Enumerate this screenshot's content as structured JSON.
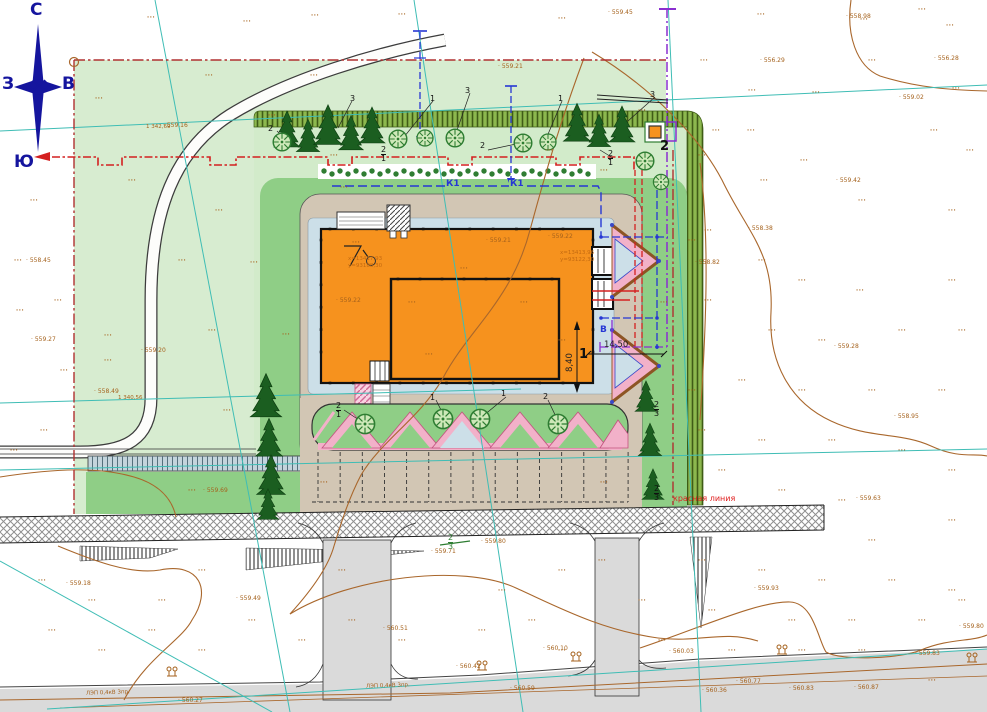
{
  "compass": {
    "n": "С",
    "s": "Ю",
    "w": "З",
    "e": "В"
  },
  "labels": {
    "red_line": "красная линия",
    "sewer": "К1",
    "water": "В",
    "dim_w": "14,50",
    "dim_h": "8,40",
    "bld_no": "1",
    "tf_no": "2",
    "power": "ЛЭП 0,4кВ 3пр.",
    "grid1": "1 342,69",
    "grid2": "1 340,56"
  },
  "coords": {
    "c1x": "х=13417,93",
    "c1y": "у=93188,30",
    "c2x": "х=13413,96",
    "c2y": "у=93122,30"
  },
  "colors": {
    "site_green": "#d7ecd0",
    "lawn_green": "#8fce86",
    "berm_green": "#8cb84e",
    "building_orange": "#f6921e",
    "pad_beige": "#d2c6b4",
    "apron_blue": "#ccdfe8",
    "road_gray": "#dadada",
    "pink": "#f2b1c9",
    "boundary_red": "#c23030",
    "utility_red": "#d42020",
    "utility_blue": "#2637d4",
    "utility_purple": "#8a2fd0",
    "survey_teal": "#3fbdb5",
    "contour_brown": "#a9672c",
    "compass_blue": "#15159e"
  },
  "elevations": [
    [
      163,
      123,
      "559.16"
    ],
    [
      498,
      64,
      "559.21"
    ],
    [
      608,
      10,
      "559.45"
    ],
    [
      846,
      14,
      "558.98"
    ],
    [
      934,
      56,
      "556.28"
    ],
    [
      899,
      95,
      "559.02"
    ],
    [
      760,
      58,
      "556.29"
    ],
    [
      836,
      178,
      "559.42"
    ],
    [
      748,
      226,
      "558.38"
    ],
    [
      695,
      260,
      "558.82"
    ],
    [
      26,
      258,
      "558.45"
    ],
    [
      31,
      337,
      "559.27"
    ],
    [
      141,
      348,
      "559.20"
    ],
    [
      94,
      389,
      "558.49"
    ],
    [
      203,
      488,
      "559.69"
    ],
    [
      336,
      298,
      "559.22"
    ],
    [
      486,
      238,
      "559.21"
    ],
    [
      548,
      234,
      "559.22"
    ],
    [
      834,
      344,
      "559.28"
    ],
    [
      894,
      414,
      "558.95"
    ],
    [
      856,
      496,
      "559.63"
    ],
    [
      66,
      581,
      "559.18"
    ],
    [
      236,
      596,
      "559.49"
    ],
    [
      431,
      549,
      "559.71"
    ],
    [
      481,
      539,
      "559.80"
    ],
    [
      543,
      646,
      "560.10"
    ],
    [
      456,
      664,
      "560.42"
    ],
    [
      669,
      649,
      "560.03"
    ],
    [
      754,
      586,
      "559.93"
    ],
    [
      915,
      651,
      "559.83"
    ],
    [
      959,
      624,
      "559.80"
    ],
    [
      736,
      679,
      "560.77"
    ],
    [
      702,
      688,
      "560.36"
    ],
    [
      789,
      686,
      "560.83"
    ],
    [
      854,
      685,
      "560.87"
    ],
    [
      178,
      698,
      "560.27"
    ],
    [
      383,
      626,
      "560.51"
    ],
    [
      510,
      686,
      "560.59"
    ]
  ],
  "veg_dots": [
    [
      147,
      15
    ],
    [
      243,
      19
    ],
    [
      311,
      13
    ],
    [
      398,
      12
    ],
    [
      558,
      16
    ],
    [
      757,
      12
    ],
    [
      860,
      17
    ],
    [
      918,
      7
    ],
    [
      946,
      23
    ],
    [
      700,
      58
    ],
    [
      812,
      90
    ],
    [
      748,
      88
    ],
    [
      868,
      58
    ],
    [
      952,
      86
    ],
    [
      930,
      128
    ],
    [
      966,
      148
    ],
    [
      747,
      128
    ],
    [
      800,
      158
    ],
    [
      712,
      128
    ],
    [
      760,
      178
    ],
    [
      858,
      198
    ],
    [
      948,
      208
    ],
    [
      704,
      228
    ],
    [
      758,
      258
    ],
    [
      798,
      278
    ],
    [
      856,
      288
    ],
    [
      948,
      278
    ],
    [
      704,
      298
    ],
    [
      768,
      328
    ],
    [
      818,
      338
    ],
    [
      898,
      328
    ],
    [
      958,
      328
    ],
    [
      738,
      378
    ],
    [
      798,
      388
    ],
    [
      868,
      388
    ],
    [
      938,
      388
    ],
    [
      698,
      428
    ],
    [
      758,
      438
    ],
    [
      828,
      438
    ],
    [
      898,
      448
    ],
    [
      948,
      468
    ],
    [
      718,
      468
    ],
    [
      778,
      488
    ],
    [
      838,
      498
    ],
    [
      948,
      518
    ],
    [
      868,
      538
    ],
    [
      698,
      558
    ],
    [
      758,
      568
    ],
    [
      818,
      578
    ],
    [
      888,
      578
    ],
    [
      948,
      588
    ],
    [
      708,
      608
    ],
    [
      788,
      618
    ],
    [
      848,
      618
    ],
    [
      918,
      618
    ],
    [
      958,
      598
    ],
    [
      728,
      648
    ],
    [
      798,
      648
    ],
    [
      858,
      648
    ],
    [
      928,
      678
    ],
    [
      638,
      598
    ],
    [
      658,
      638
    ],
    [
      598,
      558
    ],
    [
      558,
      568
    ],
    [
      498,
      588
    ],
    [
      528,
      618
    ],
    [
      558,
      648
    ],
    [
      478,
      628
    ],
    [
      398,
      638
    ],
    [
      348,
      618
    ],
    [
      298,
      638
    ],
    [
      248,
      618
    ],
    [
      198,
      648
    ],
    [
      148,
      628
    ],
    [
      98,
      648
    ],
    [
      48,
      628
    ],
    [
      158,
      598
    ],
    [
      88,
      598
    ],
    [
      38,
      578
    ],
    [
      198,
      568
    ],
    [
      338,
      568
    ],
    [
      30,
      198
    ],
    [
      14,
      258
    ],
    [
      54,
      298
    ],
    [
      16,
      308
    ],
    [
      104,
      358
    ],
    [
      40,
      428
    ],
    [
      10,
      448
    ],
    [
      60,
      368
    ],
    [
      95,
      96
    ],
    [
      205,
      73
    ],
    [
      310,
      73
    ],
    [
      128,
      178
    ],
    [
      215,
      208
    ],
    [
      178,
      258
    ],
    [
      208,
      328
    ],
    [
      104,
      333
    ],
    [
      223,
      408
    ],
    [
      188,
      488
    ],
    [
      282,
      332
    ],
    [
      250,
      260
    ],
    [
      268,
      113
    ],
    [
      330,
      153
    ],
    [
      545,
      148
    ],
    [
      638,
      108
    ],
    [
      698,
      153
    ],
    [
      600,
      168
    ],
    [
      340,
      185
    ],
    [
      352,
      240
    ],
    [
      460,
      266
    ],
    [
      425,
      352
    ],
    [
      520,
      300
    ],
    [
      558,
      338
    ],
    [
      408,
      300
    ],
    [
      688,
      238
    ],
    [
      688,
      388
    ],
    [
      660,
      300
    ],
    [
      320,
      480
    ],
    [
      600,
      480
    ]
  ],
  "plants": [
    [
      350,
      95,
      "3",
      ""
    ],
    [
      430,
      95,
      "1",
      ""
    ],
    [
      465,
      87,
      "3",
      ""
    ],
    [
      558,
      95,
      "1",
      ""
    ],
    [
      650,
      91,
      "3",
      ""
    ],
    [
      268,
      125,
      "2",
      ""
    ],
    [
      381,
      146,
      "2/1",
      ""
    ],
    [
      480,
      142,
      "2",
      ""
    ],
    [
      608,
      150,
      "2/1",
      ""
    ],
    [
      336,
      402,
      "2/1",
      ""
    ],
    [
      430,
      394,
      "1",
      ""
    ],
    [
      501,
      390,
      "1",
      ""
    ],
    [
      543,
      393,
      "2",
      ""
    ],
    [
      448,
      534,
      "2/3",
      "green"
    ],
    [
      654,
      401,
      "2/3",
      ""
    ],
    [
      654,
      485,
      "2/3",
      ""
    ]
  ],
  "trees": {
    "conifer": [
      [
        287,
        143,
        1
      ],
      [
        308,
        148,
        0.9
      ],
      [
        328,
        140,
        1.1
      ],
      [
        351,
        146,
        0.95
      ],
      [
        372,
        139,
        1
      ],
      [
        577,
        137,
        1.05
      ],
      [
        599,
        143,
        0.9
      ],
      [
        622,
        138,
        1
      ],
      [
        266,
        412,
        1.2
      ],
      [
        269,
        452,
        1.05
      ],
      [
        271,
        490,
        1.1
      ],
      [
        268,
        516,
        0.85
      ],
      [
        646,
        408,
        0.85
      ],
      [
        650,
        452,
        0.9
      ],
      [
        653,
        496,
        0.85
      ]
    ],
    "round": [
      [
        282,
        142,
        1.1
      ],
      [
        398,
        139,
        1.1
      ],
      [
        425,
        138,
        1
      ],
      [
        455,
        138,
        1.1
      ],
      [
        523,
        143,
        1.1
      ],
      [
        548,
        142,
        1
      ],
      [
        645,
        161,
        1.1
      ],
      [
        661,
        182,
        0.95
      ],
      [
        365,
        424,
        1.2
      ],
      [
        443,
        419,
        1.2
      ],
      [
        480,
        419,
        1.2
      ],
      [
        558,
        424,
        1.2
      ]
    ]
  },
  "poles": [
    [
      172,
      672
    ],
    [
      482,
      666
    ],
    [
      576,
      657
    ],
    [
      782,
      650
    ],
    [
      972,
      658
    ]
  ],
  "parking": {
    "start": 318,
    "step": 22.15,
    "count": 15,
    "top": 452,
    "bottom": 502
  },
  "hedge": {
    "x0": 324,
    "step": 8,
    "count": 34,
    "y": 171
  }
}
